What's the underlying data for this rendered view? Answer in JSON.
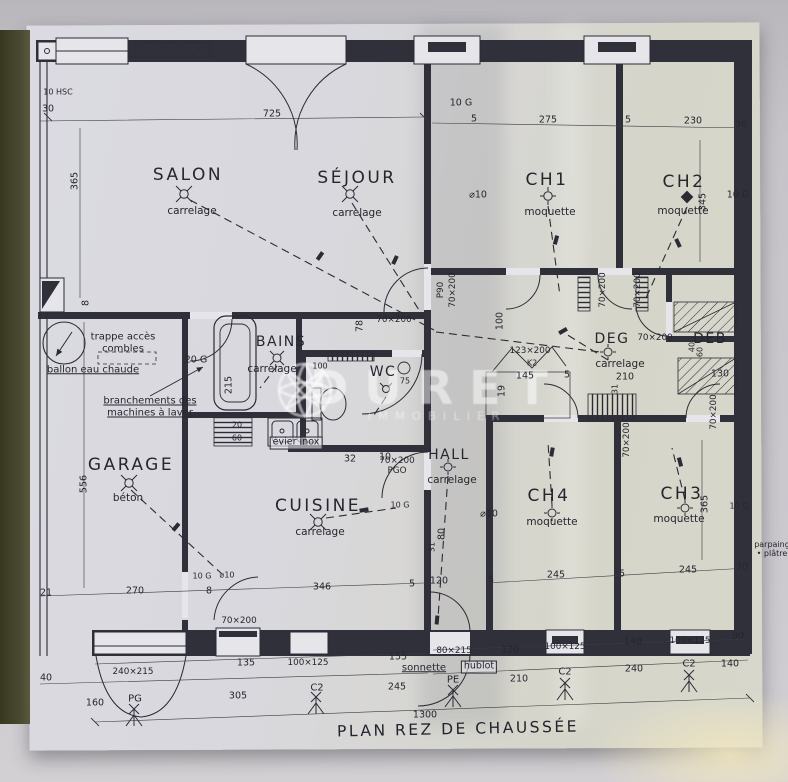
{
  "plan": {
    "title": "PLAN REZ DE CHAUSSÉE",
    "watermark": {
      "brand": "DURET",
      "tagline": "IMMOBILIER"
    },
    "colors": {
      "paper": "#d8d7dd",
      "ink": "#2b2b35",
      "desk": "#4b4a33"
    },
    "labels": [
      {
        "t": "SALON",
        "x": 188,
        "y": 176,
        "k": "room",
        "n": "room-salon"
      },
      {
        "t": "SÉJOUR",
        "x": 357,
        "y": 179,
        "k": "room",
        "n": "room-sejour"
      },
      {
        "t": "CH1",
        "x": 547,
        "y": 181,
        "k": "room",
        "n": "room-ch1"
      },
      {
        "t": "CH2",
        "x": 684,
        "y": 183,
        "k": "room",
        "n": "room-ch2"
      },
      {
        "t": "BAINS",
        "x": 281,
        "y": 342,
        "k": "room2",
        "n": "room-bains"
      },
      {
        "t": "WC",
        "x": 383,
        "y": 372,
        "k": "room2",
        "n": "room-wc"
      },
      {
        "t": "DEG",
        "x": 612,
        "y": 339,
        "k": "room2",
        "n": "room-deg"
      },
      {
        "t": "DEB",
        "x": 710,
        "y": 339,
        "k": "room2",
        "n": "room-deb"
      },
      {
        "t": "GARAGE",
        "x": 131,
        "y": 466,
        "k": "room",
        "n": "room-garage"
      },
      {
        "t": "CUISINE",
        "x": 318,
        "y": 507,
        "k": "room",
        "n": "room-cuisine"
      },
      {
        "t": "HALL",
        "x": 449,
        "y": 455,
        "k": "room2",
        "n": "room-hall"
      },
      {
        "t": "CH4",
        "x": 549,
        "y": 497,
        "k": "room",
        "n": "room-ch4"
      },
      {
        "t": "CH3",
        "x": 682,
        "y": 495,
        "k": "room",
        "n": "room-ch3"
      },
      {
        "t": "carrelage",
        "x": 192,
        "y": 211,
        "k": "mat"
      },
      {
        "t": "carrelage",
        "x": 357,
        "y": 213,
        "k": "mat"
      },
      {
        "t": "moquette",
        "x": 550,
        "y": 212,
        "k": "mat"
      },
      {
        "t": "moquette",
        "x": 683,
        "y": 211,
        "k": "mat"
      },
      {
        "t": "carrelage",
        "x": 272,
        "y": 369,
        "k": "mat"
      },
      {
        "t": "carrelage",
        "x": 620,
        "y": 364,
        "k": "mat"
      },
      {
        "t": "béton",
        "x": 128,
        "y": 498,
        "k": "mat"
      },
      {
        "t": "carrelage",
        "x": 320,
        "y": 532,
        "k": "mat"
      },
      {
        "t": "carrelage",
        "x": 452,
        "y": 480,
        "k": "mat"
      },
      {
        "t": "moquette",
        "x": 552,
        "y": 522,
        "k": "mat"
      },
      {
        "t": "moquette",
        "x": 679,
        "y": 519,
        "k": "mat"
      },
      {
        "t": "trappe accès\ncombles",
        "x": 123,
        "y": 343,
        "k": "note"
      },
      {
        "t": "ballon eau chaude",
        "x": 93,
        "y": 370,
        "k": "noteu"
      },
      {
        "t": "branchements des\nmachines à laver",
        "x": 150,
        "y": 407,
        "k": "noteu"
      },
      {
        "t": "évier inox",
        "x": 296,
        "y": 443,
        "k": "box"
      },
      {
        "t": "sonnette",
        "x": 424,
        "y": 668,
        "k": "noteu"
      },
      {
        "t": "hublot",
        "x": 479,
        "y": 667,
        "k": "box"
      },
      {
        "t": "parpaing\n• plâtre",
        "x": 772,
        "y": 549,
        "k": "tiny"
      },
      {
        "t": "10 HSC",
        "x": 58,
        "y": 92,
        "k": "tiny"
      },
      {
        "t": "70×200",
        "x": 239,
        "y": 621,
        "k": "door"
      },
      {
        "t": "70×200",
        "x": 394,
        "y": 320,
        "k": "door"
      },
      {
        "t": "70×200\nPGO",
        "x": 397,
        "y": 466,
        "k": "door"
      },
      {
        "t": "P90",
        "x": 441,
        "y": 290,
        "k": "door",
        "r": -90
      },
      {
        "t": "70×200",
        "x": 453,
        "y": 290,
        "k": "door",
        "r": -90
      },
      {
        "t": "70×200",
        "x": 603,
        "y": 290,
        "k": "door",
        "r": -90
      },
      {
        "t": "70×200",
        "x": 638,
        "y": 290,
        "k": "door",
        "r": -90
      },
      {
        "t": "70×200",
        "x": 655,
        "y": 338,
        "k": "door"
      },
      {
        "t": "70×200",
        "x": 714,
        "y": 412,
        "k": "door",
        "r": -90
      },
      {
        "t": "70×200",
        "x": 627,
        "y": 440,
        "k": "door",
        "r": -90
      },
      {
        "t": "240×215",
        "x": 133,
        "y": 672,
        "k": "door"
      },
      {
        "t": "80×215",
        "x": 454,
        "y": 651,
        "k": "door"
      },
      {
        "t": "100×125",
        "x": 308,
        "y": 663,
        "k": "door"
      },
      {
        "t": "100×125",
        "x": 565,
        "y": 647,
        "k": "door"
      },
      {
        "t": "100×125",
        "x": 690,
        "y": 641,
        "k": "door"
      },
      {
        "t": "123×200",
        "x": 530,
        "y": 351,
        "k": "door"
      },
      {
        "t": "K2",
        "x": 532,
        "y": 363,
        "k": "tiny"
      },
      {
        "t": "30",
        "x": 48,
        "y": 110,
        "k": "dim"
      },
      {
        "t": "725",
        "x": 272,
        "y": 115,
        "k": "dim"
      },
      {
        "t": "10 G",
        "x": 461,
        "y": 104,
        "k": "dim"
      },
      {
        "t": "5",
        "x": 474,
        "y": 120,
        "k": "dim"
      },
      {
        "t": "275",
        "x": 548,
        "y": 121,
        "k": "dim"
      },
      {
        "t": "5",
        "x": 628,
        "y": 121,
        "k": "dim"
      },
      {
        "t": "230",
        "x": 693,
        "y": 122,
        "k": "dim"
      },
      {
        "t": "30",
        "x": 741,
        "y": 126,
        "k": "dim"
      },
      {
        "t": "365",
        "x": 76,
        "y": 181,
        "k": "dim",
        "r": -90
      },
      {
        "t": "8",
        "x": 87,
        "y": 303,
        "k": "dim",
        "r": -90
      },
      {
        "t": "556",
        "x": 85,
        "y": 484,
        "k": "dim",
        "r": -90
      },
      {
        "t": "⌀10",
        "x": 478,
        "y": 196,
        "k": "dim"
      },
      {
        "t": "10 G",
        "x": 738,
        "y": 196,
        "k": "dim"
      },
      {
        "t": "345",
        "x": 704,
        "y": 202,
        "k": "dim",
        "r": -90
      },
      {
        "t": "100",
        "x": 501,
        "y": 321,
        "k": "dim",
        "r": -90
      },
      {
        "t": "20 G",
        "x": 196,
        "y": 361,
        "k": "dim"
      },
      {
        "t": "215",
        "x": 230,
        "y": 385,
        "k": "dim",
        "r": -90
      },
      {
        "t": "20",
        "x": 237,
        "y": 425,
        "k": "tiny"
      },
      {
        "t": "60",
        "x": 237,
        "y": 438,
        "k": "tiny"
      },
      {
        "t": "32",
        "x": 350,
        "y": 460,
        "k": "dim"
      },
      {
        "t": "10",
        "x": 385,
        "y": 458,
        "k": "dim"
      },
      {
        "t": "78",
        "x": 361,
        "y": 326,
        "k": "dim",
        "r": -90
      },
      {
        "t": "75",
        "x": 405,
        "y": 381,
        "k": "tiny"
      },
      {
        "t": "100",
        "x": 320,
        "y": 366,
        "k": "tiny"
      },
      {
        "t": "145",
        "x": 525,
        "y": 377,
        "k": "dim"
      },
      {
        "t": "5",
        "x": 567,
        "y": 376,
        "k": "dim"
      },
      {
        "t": "19",
        "x": 503,
        "y": 391,
        "k": "dim",
        "r": -90
      },
      {
        "t": "210",
        "x": 625,
        "y": 378,
        "k": "dim"
      },
      {
        "t": "31",
        "x": 615,
        "y": 389,
        "k": "tiny",
        "r": -90
      },
      {
        "t": "130",
        "x": 720,
        "y": 375,
        "k": "dim"
      },
      {
        "t": "40",
        "x": 692,
        "y": 347,
        "k": "tiny",
        "r": -90
      },
      {
        "t": "60",
        "x": 700,
        "y": 352,
        "k": "tiny",
        "r": -90
      },
      {
        "t": "21",
        "x": 46,
        "y": 594,
        "k": "dim"
      },
      {
        "t": "270",
        "x": 135,
        "y": 592,
        "k": "dim"
      },
      {
        "t": "10 G",
        "x": 202,
        "y": 576,
        "k": "tiny"
      },
      {
        "t": "⌀10",
        "x": 227,
        "y": 575,
        "k": "tiny"
      },
      {
        "t": "8",
        "x": 209,
        "y": 592,
        "k": "dim"
      },
      {
        "t": "346",
        "x": 322,
        "y": 588,
        "k": "dim"
      },
      {
        "t": "5",
        "x": 412,
        "y": 585,
        "k": "dim"
      },
      {
        "t": "120",
        "x": 439,
        "y": 582,
        "k": "dim"
      },
      {
        "t": "⌀10",
        "x": 489,
        "y": 515,
        "k": "dim"
      },
      {
        "t": "10 G",
        "x": 400,
        "y": 505,
        "k": "tiny"
      },
      {
        "t": "80",
        "x": 443,
        "y": 534,
        "k": "dim",
        "r": -90
      },
      {
        "t": "31",
        "x": 432,
        "y": 547,
        "k": "tiny",
        "r": -90
      },
      {
        "t": "5",
        "x": 491,
        "y": 581,
        "k": "dim"
      },
      {
        "t": "245",
        "x": 556,
        "y": 576,
        "k": "dim"
      },
      {
        "t": "5",
        "x": 622,
        "y": 575,
        "k": "dim"
      },
      {
        "t": "245",
        "x": 688,
        "y": 571,
        "k": "dim"
      },
      {
        "t": "30",
        "x": 742,
        "y": 568,
        "k": "dim"
      },
      {
        "t": "365",
        "x": 706,
        "y": 504,
        "k": "dim",
        "r": -90
      },
      {
        "t": "10 G",
        "x": 739,
        "y": 506,
        "k": "tiny"
      },
      {
        "t": "135",
        "x": 246,
        "y": 664,
        "k": "dim"
      },
      {
        "t": "155",
        "x": 398,
        "y": 658,
        "k": "dim"
      },
      {
        "t": "120",
        "x": 510,
        "y": 651,
        "k": "dim"
      },
      {
        "t": "140",
        "x": 633,
        "y": 643,
        "k": "dim"
      },
      {
        "t": "90",
        "x": 738,
        "y": 637,
        "k": "dim"
      },
      {
        "t": "40",
        "x": 46,
        "y": 679,
        "k": "dim"
      },
      {
        "t": "160",
        "x": 95,
        "y": 704,
        "k": "dim"
      },
      {
        "t": "305",
        "x": 238,
        "y": 697,
        "k": "dim"
      },
      {
        "t": "245",
        "x": 397,
        "y": 688,
        "k": "dim"
      },
      {
        "t": "210",
        "x": 519,
        "y": 680,
        "k": "dim"
      },
      {
        "t": "240",
        "x": 634,
        "y": 670,
        "k": "dim"
      },
      {
        "t": "140",
        "x": 730,
        "y": 665,
        "k": "dim"
      },
      {
        "t": "1300",
        "x": 425,
        "y": 716,
        "k": "dim"
      },
      {
        "t": "PG",
        "x": 135,
        "y": 699,
        "k": "marker",
        "n": "section-marker-pg"
      },
      {
        "t": "C2",
        "x": 317,
        "y": 688,
        "k": "marker",
        "n": "section-marker-c2"
      },
      {
        "t": "PE",
        "x": 453,
        "y": 680,
        "k": "marker",
        "n": "section-marker-pe"
      },
      {
        "t": "C2",
        "x": 565,
        "y": 672,
        "k": "marker",
        "n": "section-marker-c2"
      },
      {
        "t": "C2",
        "x": 689,
        "y": 664,
        "k": "marker",
        "n": "section-marker-c2"
      }
    ]
  }
}
